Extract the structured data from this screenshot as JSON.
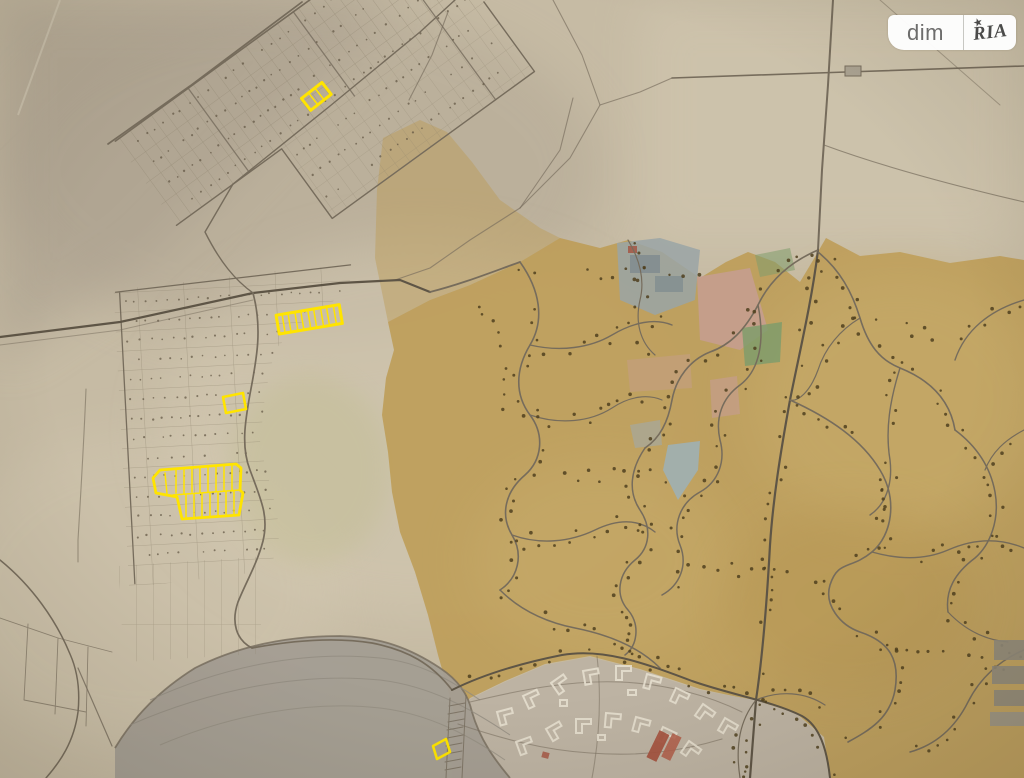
{
  "brand": {
    "left": "dim",
    "right": "RIA",
    "star": "★"
  },
  "map": {
    "kind": "scanned cadastral town plan photo",
    "palette": {
      "paper": "#c6bba4",
      "paper_dark": "#a89d8c",
      "paper_light": "#d5cbb4",
      "ochre": "#bd9c55",
      "ochre_light": "#cbb070",
      "road": "#766c5c",
      "road_dark": "#5e5546",
      "tree_dot": "#4f3f1f",
      "parcel_dot": "#5f5442",
      "parcel_line": "#8a7f6a",
      "lake": "#a39d92",
      "pond": "#9fb0b4",
      "industrial_block": "#9aa4a6",
      "pink_block": "#c79d95",
      "green_block": "#7f9c6b",
      "red_building": "#a4513e",
      "neighborhood": "#bdb3a3",
      "building_outline": "#e6dfcf",
      "highlight": "#ffe400",
      "badge_bg": "#ffffff",
      "badge_text": "#6a6a6a",
      "badge_logo": "#474747"
    },
    "highlighted_plots": [
      {
        "id": "plot-north-band",
        "cells": 2,
        "location": "upper diagonal allotment band"
      },
      {
        "id": "plot-west-strip",
        "cells": 10,
        "location": "western allotments, long subdivided strip"
      },
      {
        "id": "plot-west-single",
        "cells": 1,
        "location": "western allotments, single parcel"
      },
      {
        "id": "plot-west-block",
        "cells": 16,
        "location": "western allotments, double-row block"
      },
      {
        "id": "plot-south-single",
        "cells": 1,
        "location": "southern neighborhood edge"
      }
    ]
  }
}
